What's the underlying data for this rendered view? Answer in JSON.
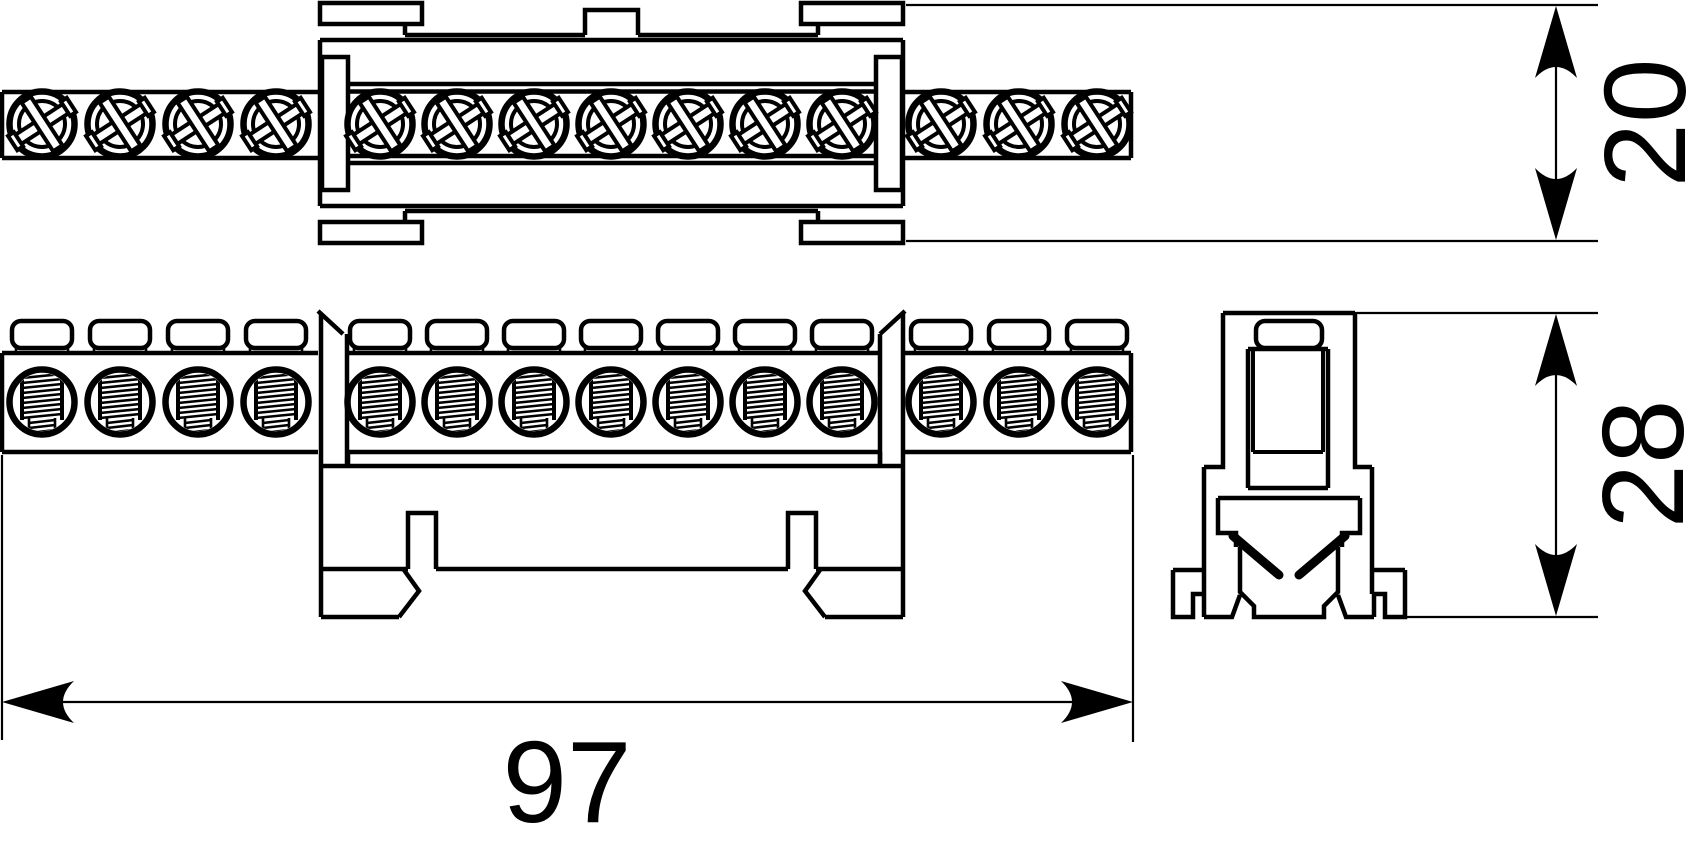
{
  "document": {
    "type": "technical-drawing",
    "subject": "screw terminal busbar with DIN-rail mounting base",
    "views": {
      "top": "top-view",
      "front": "front-view",
      "side": "side-section-view"
    }
  },
  "dimensions": {
    "length": {
      "label": "97"
    },
    "height_top_view": {
      "label": "20"
    },
    "height_front_view": {
      "label": "28"
    }
  },
  "drawing": {
    "line_color": "#000000",
    "background_color": "#ffffff",
    "terminal_pitch_px": 77,
    "visible_terminal_count": 14,
    "top_view_screw_xs": [
      42,
      120,
      198,
      276,
      380,
      457,
      534,
      611,
      688,
      765,
      842,
      941,
      1019,
      1097
    ],
    "front_view_terminal_xs": [
      42,
      120,
      198,
      276,
      380,
      457,
      534,
      611,
      688,
      765,
      842,
      941,
      1019,
      1097
    ]
  }
}
